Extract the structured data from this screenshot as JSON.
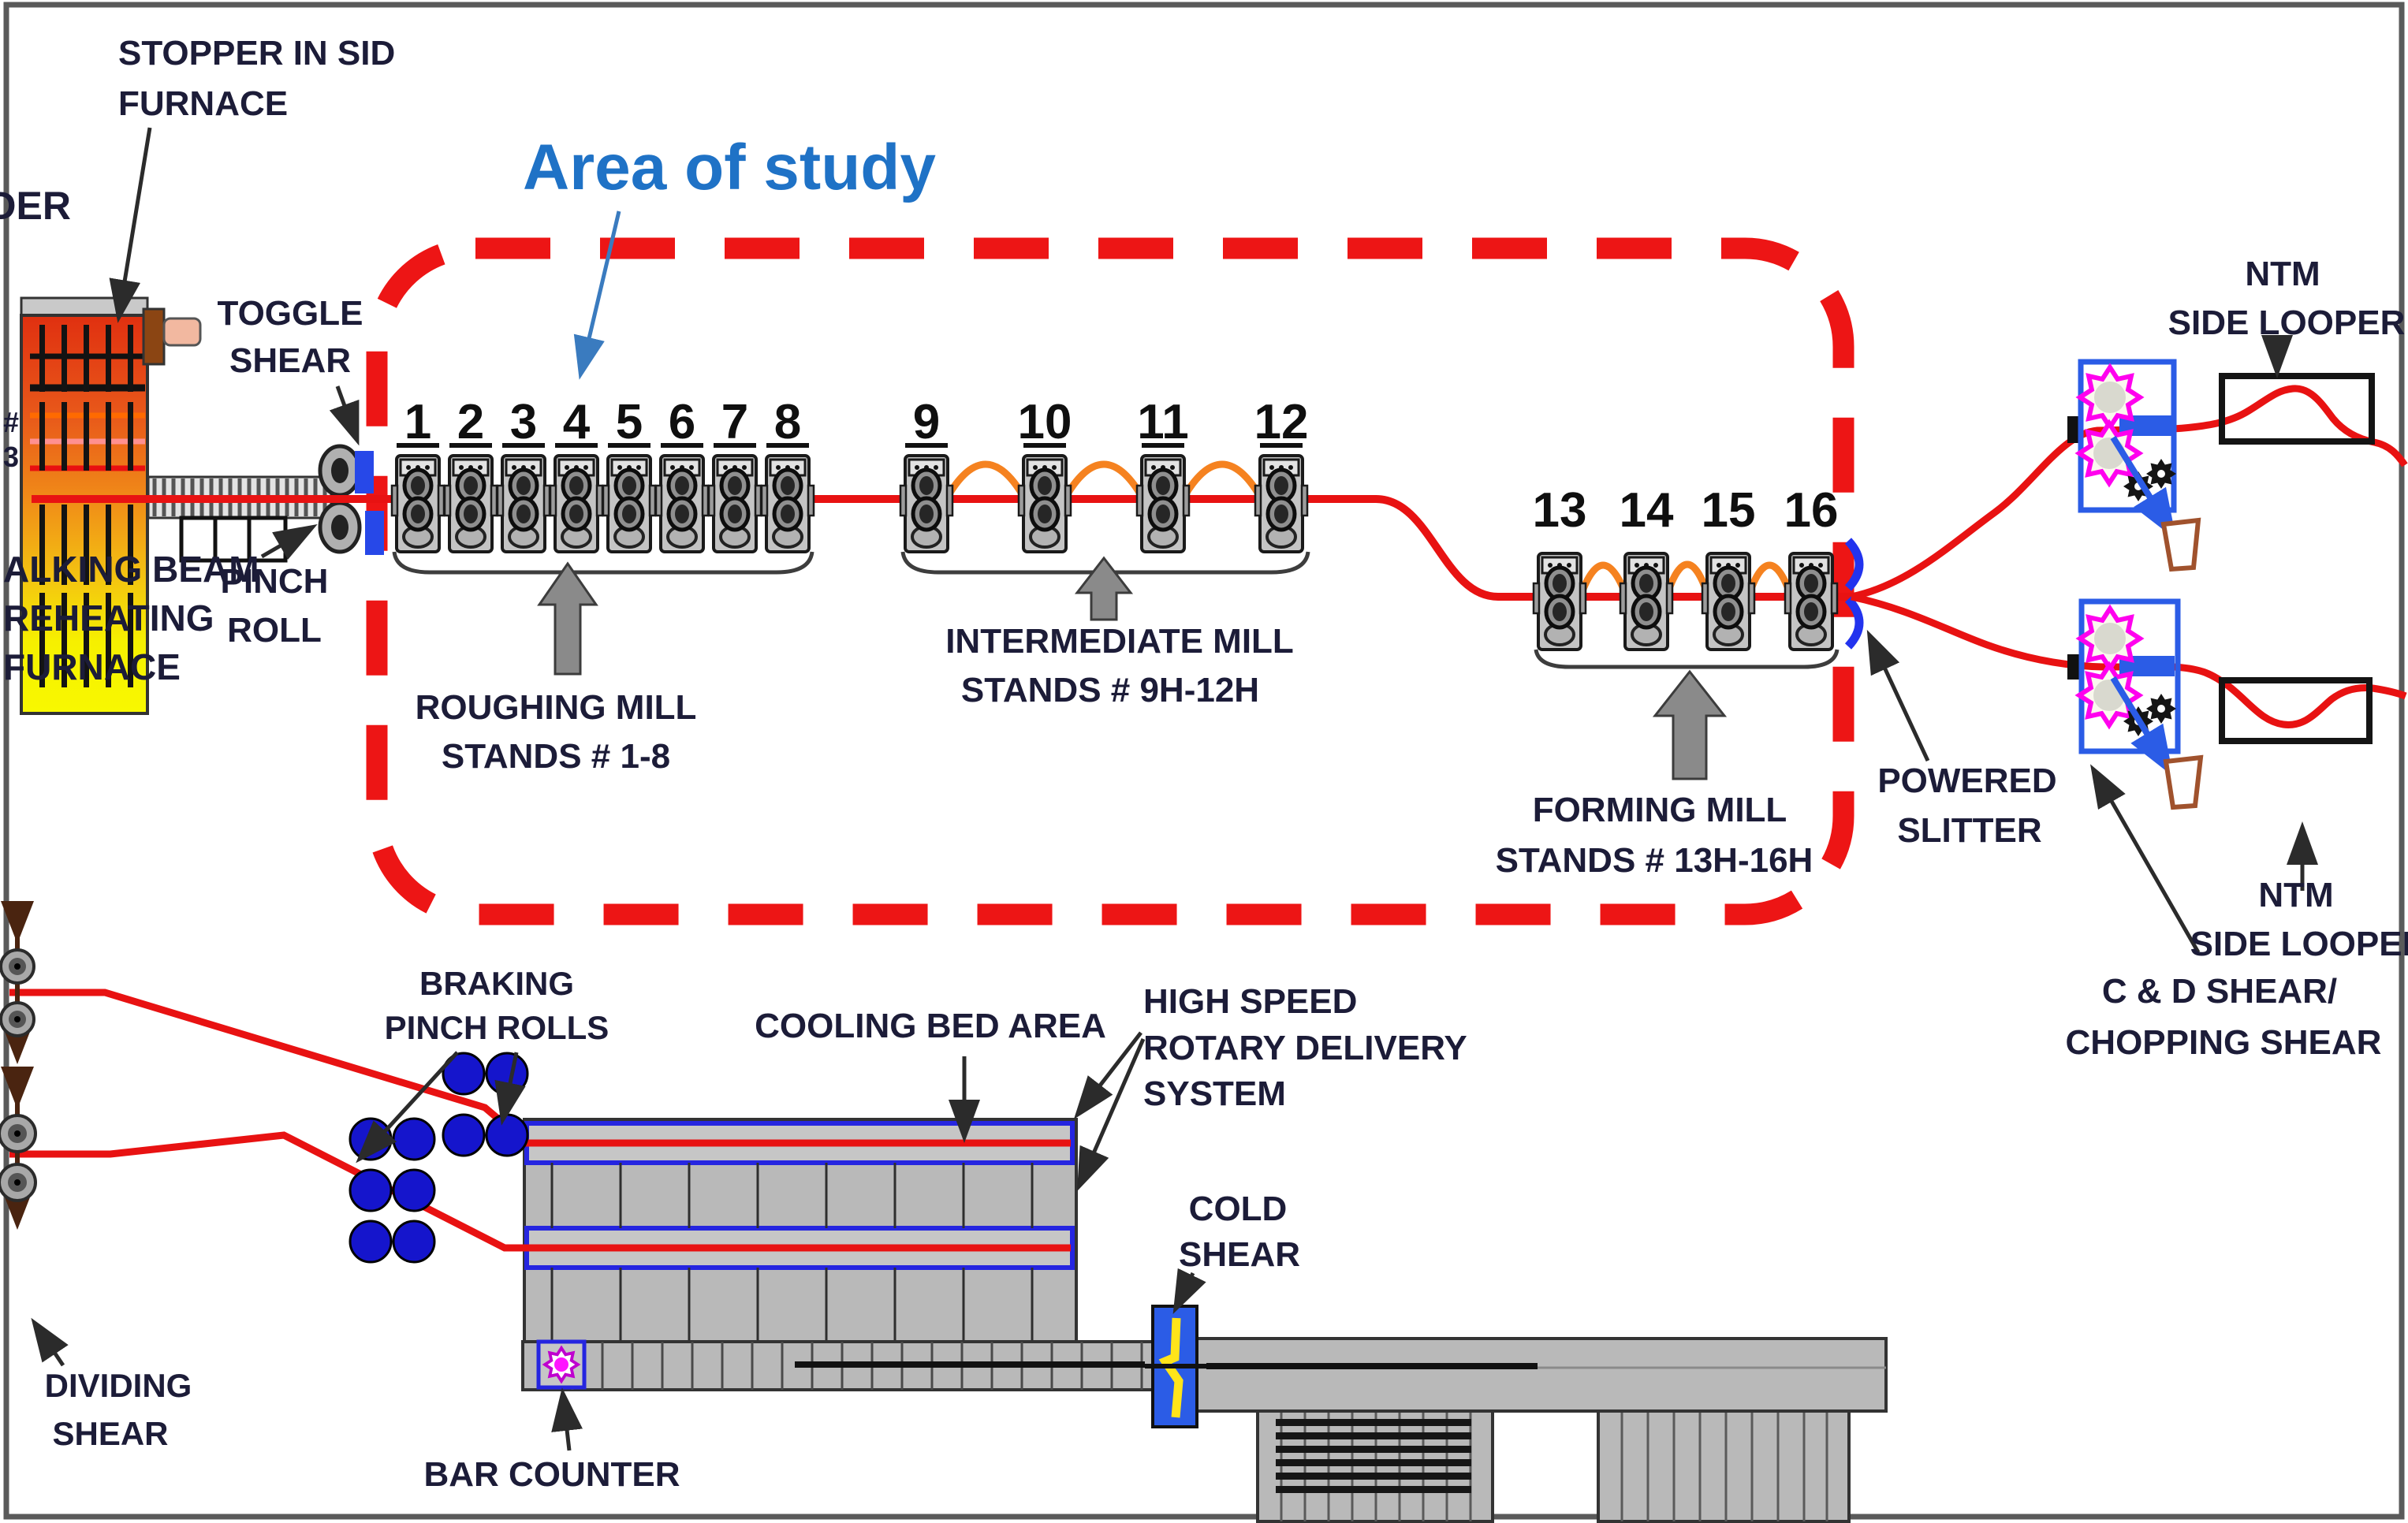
{
  "annotation": {
    "area_of_study": "Area of study",
    "color": "#1F72C6"
  },
  "labels": {
    "stopper_l1": "STOPPER IN SID",
    "stopper_l2": "FURNACE",
    "edge_top": "WDER",
    "edge_hash": "#",
    "edge_num": "3",
    "toggle_l1": "TOGGLE",
    "toggle_l2": "SHEAR",
    "pinch_l1": "PINCH",
    "pinch_l2": "ROLL",
    "furnace_l1": "ALKING BEAM",
    "furnace_l2": "REHEATING",
    "furnace_l3": "FURNACE",
    "powered_l1": "POWERED",
    "powered_l2": "SLITTER",
    "ntm_top_l1": "NTM",
    "ntm_top_l2": "SIDE LOOPER",
    "ntm_bot_l1": "NTM",
    "ntm_bot_l2": "SIDE LOOPER",
    "cd_l1": "C & D SHEAR/",
    "cd_l2": "CHOPPING SHEAR",
    "braking_l1": "BRAKING",
    "braking_l2": "PINCH ROLLS",
    "cooling": "COOLING BED AREA",
    "high_l1": "HIGH SPEED",
    "high_l2": "ROTARY DELIVERY",
    "high_l3": "SYSTEM",
    "cold_l1": "COLD",
    "cold_l2": "SHEAR",
    "bar_counter": "BAR COUNTER",
    "dividing_l1": "DIVIDING",
    "dividing_l2": "SHEAR"
  },
  "stands": {
    "roughing": {
      "numbers": [
        "1",
        "2",
        "3",
        "4",
        "5",
        "6",
        "7",
        "8"
      ],
      "label_l1": "ROUGHING MILL",
      "label_l2": "STANDS # 1-8"
    },
    "intermediate": {
      "numbers": [
        "9",
        "10",
        "11",
        "12"
      ],
      "label_l1": "INTERMEDIATE MILL",
      "label_l2": "STANDS # 9H-12H"
    },
    "forming": {
      "numbers": [
        "13",
        "14",
        "15",
        "16"
      ],
      "label_l1": "FORMING MILL",
      "label_l2": "STANDS # 13H-16H"
    }
  },
  "colors": {
    "line_red": "#E81212",
    "dash_red": "#ED1515",
    "loop_orange": "#F58220",
    "equipment_blue": "#2B5CE6",
    "gear_magenta": "#FF00EE",
    "pinch_blue": "#1515CC",
    "shear_yellow": "#FFE41A",
    "label_dark": "#1c1c38"
  }
}
